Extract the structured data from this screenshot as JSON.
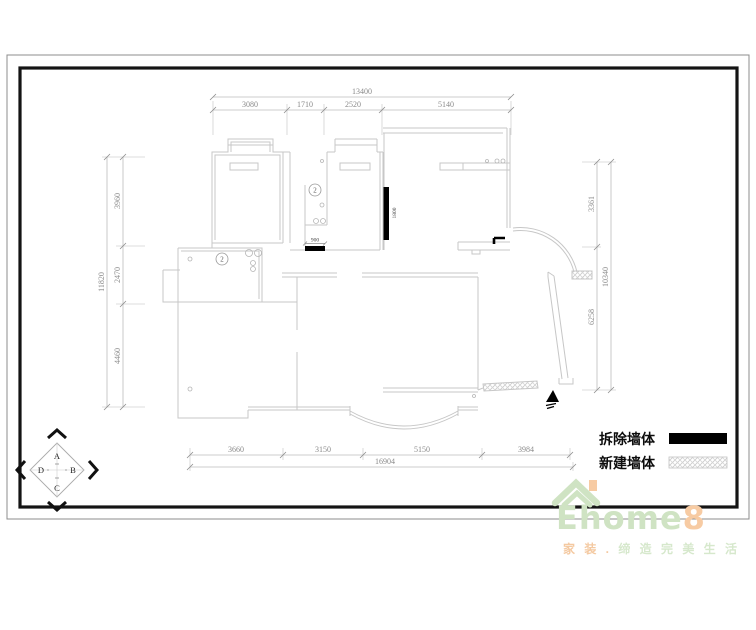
{
  "dims": {
    "top": {
      "overall": "13400",
      "segments": [
        "3080",
        "1710",
        "2520",
        "5140"
      ]
    },
    "left": {
      "overall": "11820",
      "segments": [
        "3960",
        "2470",
        "4460"
      ]
    },
    "right": {
      "overall": "10340",
      "segments": [
        "3361",
        "6258"
      ]
    },
    "bottom": {
      "overall": "16904",
      "segments": [
        "3660",
        "3150",
        "5150",
        "3984"
      ]
    },
    "inline": {
      "demolish_wall": "1800",
      "opening": "900"
    }
  },
  "plan": {
    "room_tag": "2"
  },
  "legend": {
    "demolish_label": "拆除墙体",
    "new_label": "新建墙体"
  },
  "compass": {
    "top": "A",
    "right": "B",
    "bottom": "C",
    "left": "D"
  },
  "watermark": {
    "brand_green": "Ehome",
    "brand_orange": "8",
    "tagline_orange": "家 装 .",
    "tagline_green": " 缔 造 完 美 生 活"
  },
  "colors": {
    "demolish_fill": "#000000",
    "wall_line": "#c7c7c7",
    "frame": "#141414",
    "brand_green": "#cfe3c3",
    "brand_orange": "#f7cba3"
  }
}
